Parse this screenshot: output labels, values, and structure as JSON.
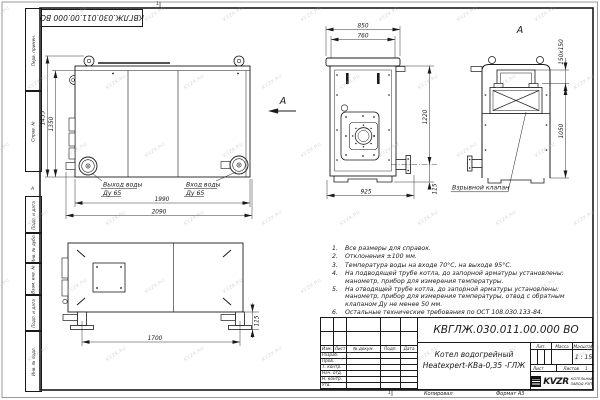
{
  "frame": {
    "corner_designation": "КВГЛЖ.030.011.00.000 ВО",
    "left_labels": [
      "Перв. примен.",
      "Справ. №",
      "Подп. и дата",
      "Инв. № дубл.",
      "Взам. инв. №",
      "Подп. и дата",
      "Инв. № подл."
    ],
    "zone_letter": "А",
    "zone_number_top": "1",
    "zone_number_bottom": "1"
  },
  "views": {
    "main": {
      "dim_height_outer": "1455",
      "dim_height_inner": "1350",
      "dim_width_inner": "1990",
      "dim_width_outer": "2090",
      "outlet_label": "Выход воды",
      "outlet_size": "Ду 65",
      "inlet_label": "Вход воды",
      "inlet_size": "Ду 65",
      "view_arrow_label": "А"
    },
    "front": {
      "dim_top_outer": "850",
      "dim_top_inner": "760",
      "dim_height": "1220",
      "dim_bottom": "925",
      "dim_foot": "115"
    },
    "view_a": {
      "label": "А",
      "dim_flue": "150х150",
      "dim_height": "1050",
      "callout": "Взрывной клапан"
    },
    "top": {
      "dim_legs": "1700",
      "dim_foot": "115"
    }
  },
  "notes": [
    {
      "n": "1.",
      "text": "Все размеры для справок."
    },
    {
      "n": "2.",
      "text": "Отклонения ±100 мм."
    },
    {
      "n": "3.",
      "text": "Температура воды на входе 70°С, на выходе 95°С."
    },
    {
      "n": "4.",
      "text": "На подводящей трубе котла, до запорной арматуры установлены: манометр, прибор для измерения температуры."
    },
    {
      "n": "5.",
      "text": "На отводящей трубе котла, до запорной арматуры установлены: манометр, прибор для измерения температуры, отвод с обратным клапаном Ду не менее 50 мм."
    },
    {
      "n": "6.",
      "text": "Остальные технические требования по ОСТ 108.030.133-84."
    }
  ],
  "title_block": {
    "designation": "КВГЛЖ.030.011.00.000 ВО",
    "product_name_line1": "Котел водогрейный",
    "product_name_line2": "Heatexpert-КВа-0,35 -ГЛЖ",
    "change_cols": [
      "Изм.",
      "Лист",
      "№ докум.",
      "Подп.",
      "Дата"
    ],
    "sign_rows": [
      "Разраб.",
      "Пров.",
      "Т. контр.",
      "Нач. отд.",
      "Н. контр.",
      "Утв."
    ],
    "lit_label": "Лит.",
    "mass_label": "Масса",
    "scale_label": "Масштаб",
    "scale_value": "1 : 15",
    "sheet_label": "Лист",
    "sheets_label": "Листов",
    "sheets_value": "1",
    "company": "KVZR",
    "company_line1": "КОТЕЛЬНЫЙ",
    "company_line2": "ЗАВОД РЭП",
    "copied": "Копировал",
    "format": "Формат А3"
  },
  "watermark": {
    "text": "KVZR.RU"
  }
}
